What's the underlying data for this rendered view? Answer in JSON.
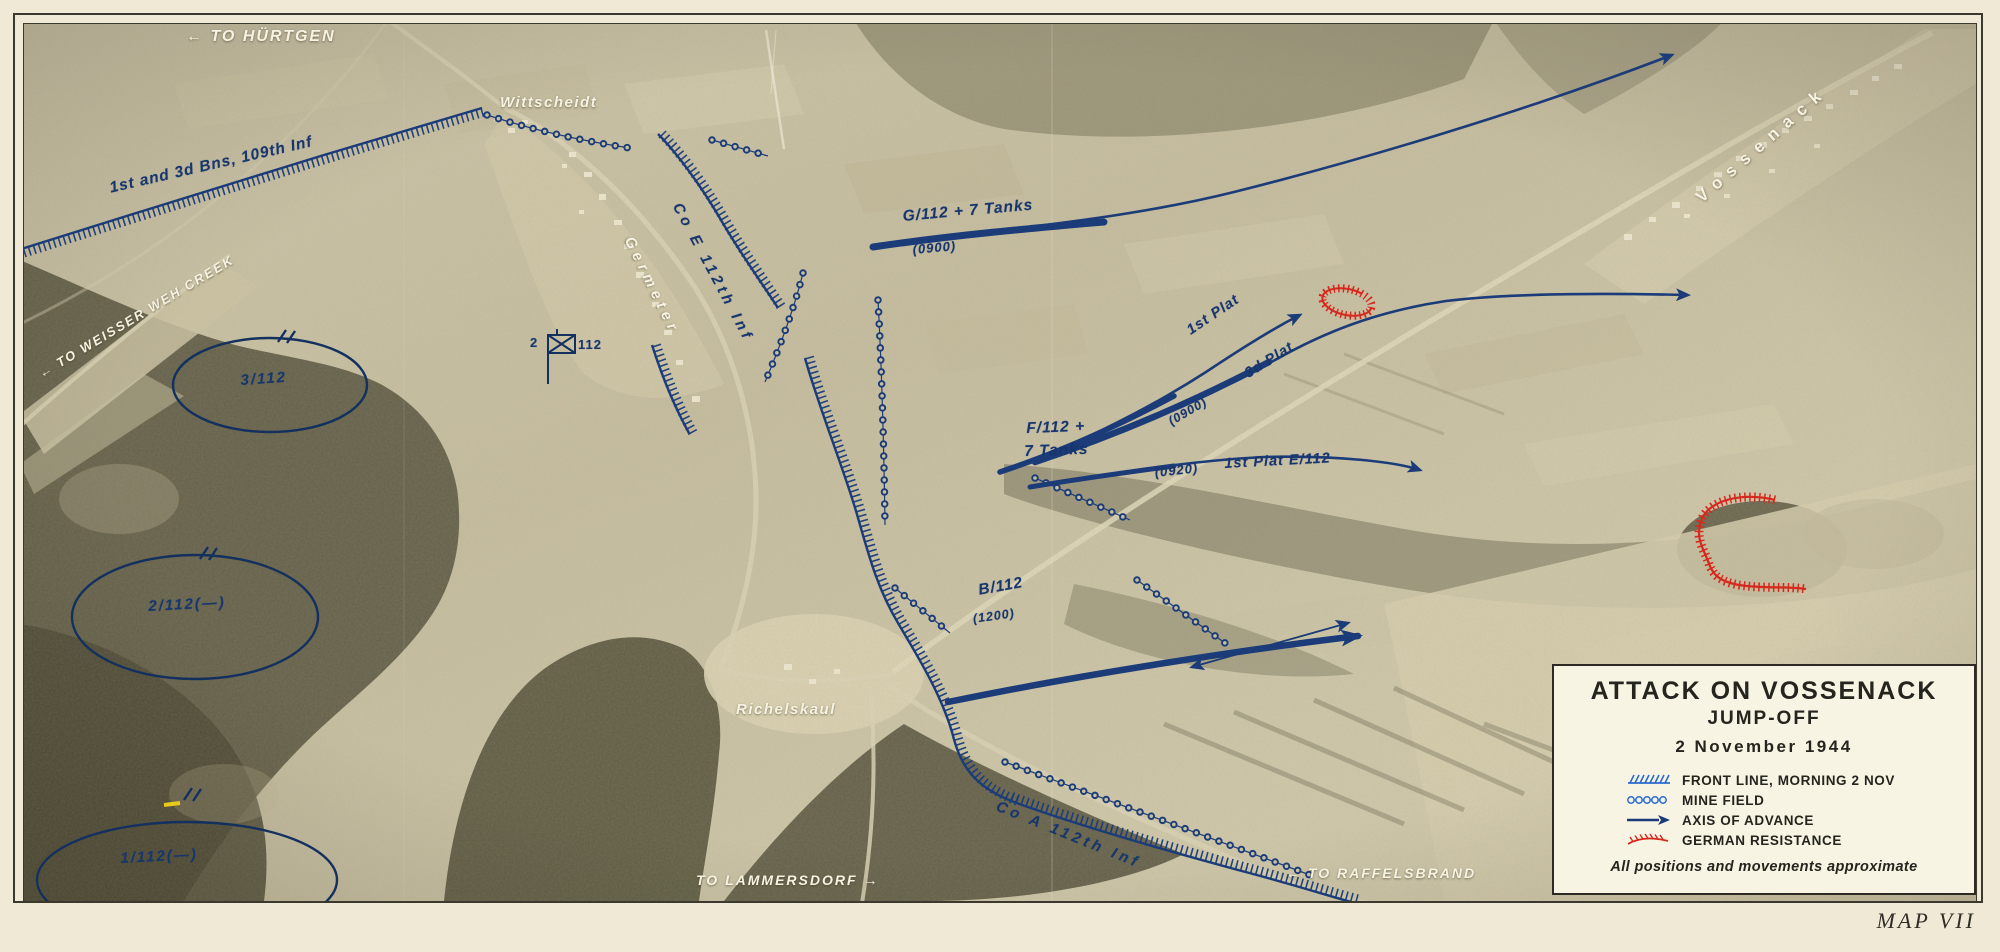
{
  "page": {
    "map_number": "MAP VII"
  },
  "legend": {
    "title": "ATTACK ON VOSSENACK",
    "subtitle": "JUMP-OFF",
    "date": "2 November 1944",
    "items": [
      {
        "symbol": "front-line",
        "label": "FRONT LINE, MORNING 2 NOV"
      },
      {
        "symbol": "mine-field",
        "label": "MINE FIELD"
      },
      {
        "symbol": "axis-of-advance",
        "label": "AXIS OF ADVANCE"
      },
      {
        "symbol": "german-resistance",
        "label": "GERMAN RESISTANCE"
      }
    ],
    "note": "All positions and movements approximate"
  },
  "places": {
    "huertgen": "← TO HÜRTGEN",
    "wittscheidt": "Wittscheidt",
    "weisser_weh": "← TO WEISSER WEH CREEK",
    "germeter": "Germeter",
    "richelskaul": "Richelskaul",
    "lammersdorf": "TO LAMMERSDORF →",
    "raffelsbrand": "← TO RAFFELSBRAND",
    "vossenack": "Vossenack"
  },
  "units": {
    "bns109": "1st and 3d Bns, 109th Inf",
    "co_e": "Co E 112th Inf",
    "co_a": "Co A 112th Inf",
    "g112": "G/112 + 7 Tanks",
    "g112_time": "(0900)",
    "f112_line1": "F/112 +",
    "f112_line2": "7 Tanks",
    "plat1": "1st Plat",
    "plat3": "3d Plat",
    "f112_time": "(0900)",
    "e112_time": "(0920)",
    "e112": "1st Plat E/112",
    "b112": "B/112",
    "b112_time": "(1200)",
    "bn3": "3/112",
    "bn2": "2/112(—)",
    "bn1": "1/112(—)",
    "cp_left": "2",
    "cp_right": "112"
  },
  "colors": {
    "friendly_blue": "#1b3c78",
    "enemy_red": "#d6281c",
    "photo_label_white": "#f7f3e3",
    "paper": "#f0e9d5"
  }
}
